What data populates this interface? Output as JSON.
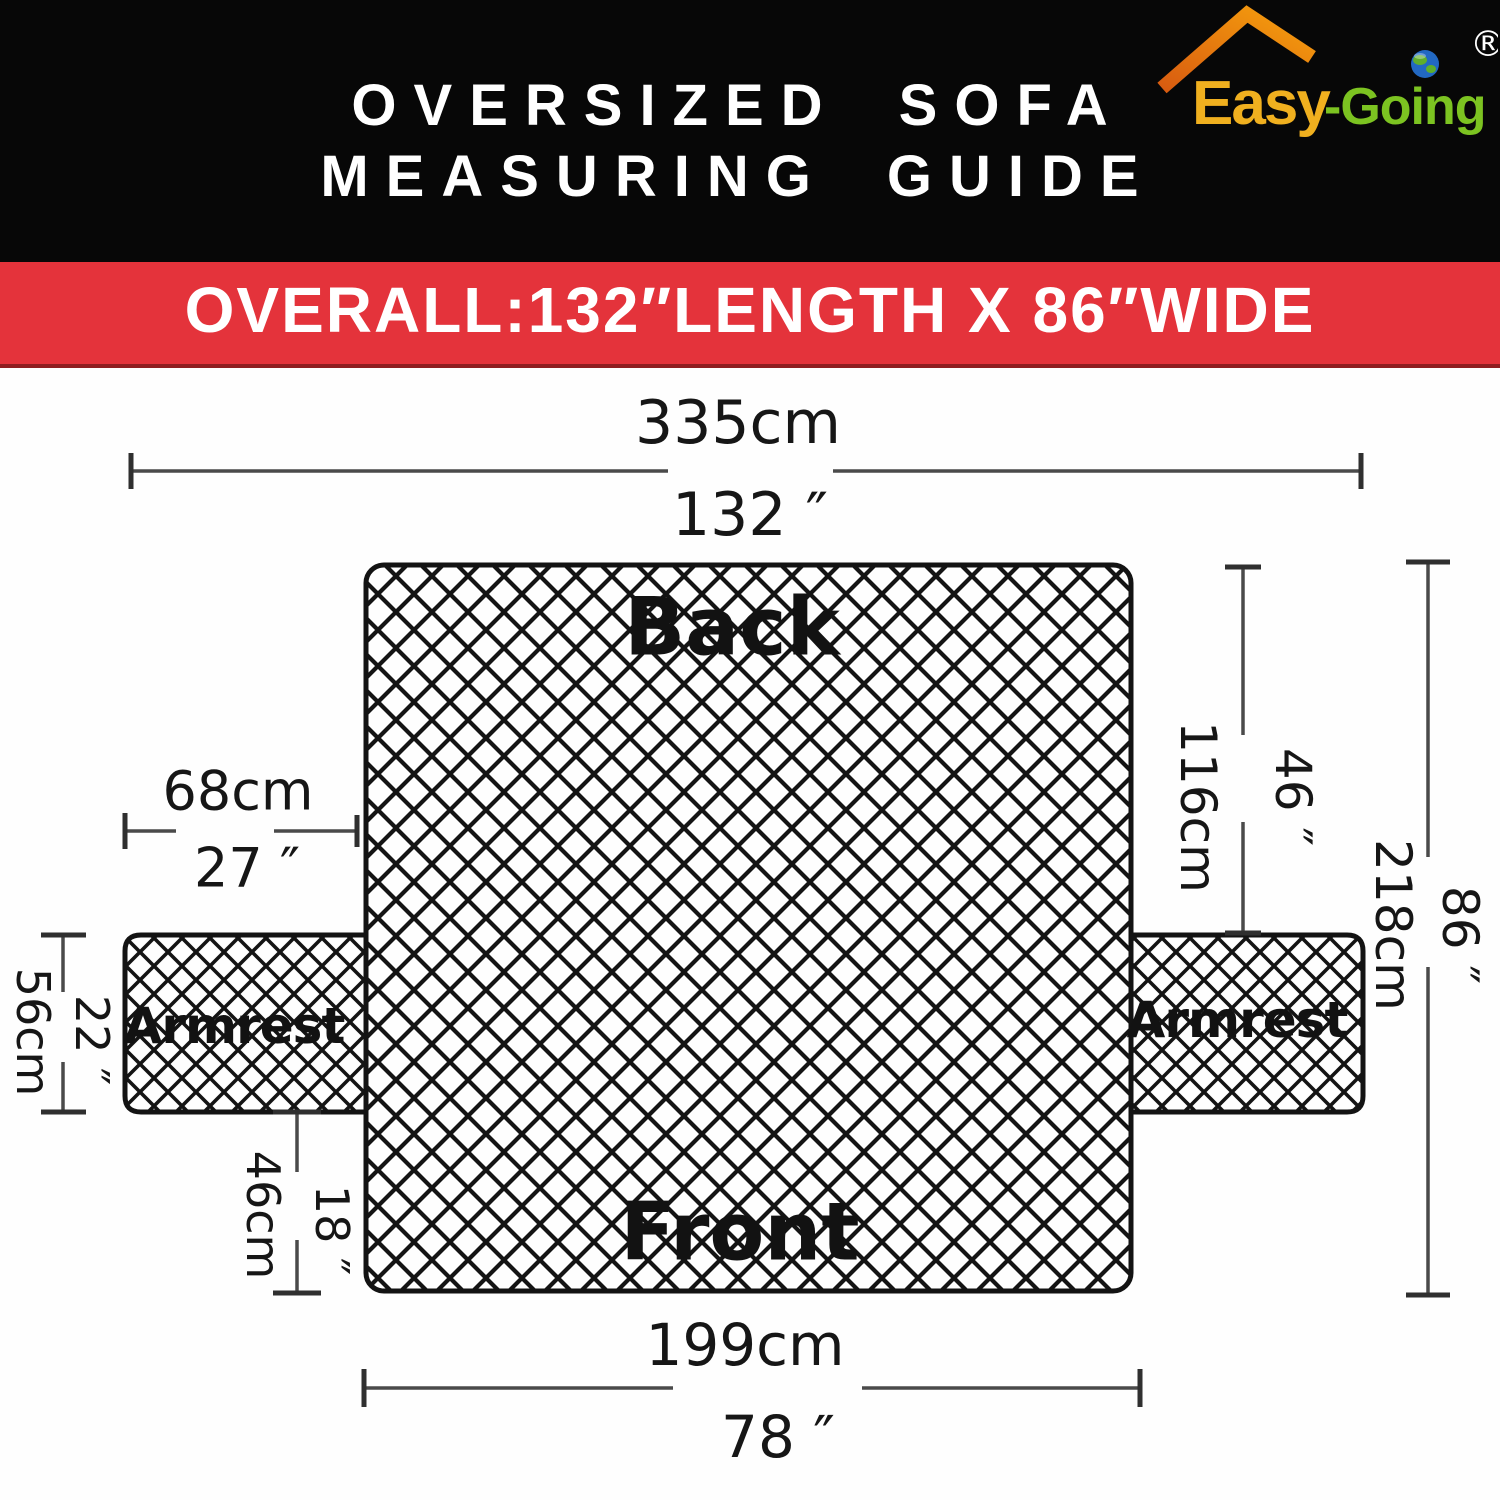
{
  "header": {
    "title_line1": "OVERSIZED SOFA",
    "title_line2": "MEASURING GUIDE",
    "bg_color": "#070707"
  },
  "logo": {
    "brand_first": "Easy",
    "brand_rest": "-Going",
    "registered_mark": "®",
    "colors": {
      "roof_dark": "#d85c10",
      "roof_light": "#f6a00d",
      "easy_gold": "#f0b01f",
      "going_green": "#7cc321",
      "globe_blue": "#2268c2",
      "globe_land": "#5fae2b"
    }
  },
  "banner": {
    "text": "OVERALL:132″LENGTH X 86″WIDE",
    "bg_color": "#e4333b",
    "text_color": "#ffffff"
  },
  "diagram": {
    "section_labels": {
      "back": "Back",
      "front": "Front",
      "armrest_left": "Armrest",
      "armrest_right": "Armrest"
    },
    "dimensions": {
      "overall_length": {
        "cm": "335cm",
        "inch": "132 ″"
      },
      "armrest_length": {
        "cm": "68cm",
        "inch": "27 ″"
      },
      "back_height": {
        "cm": "116cm",
        "inch": "46 ″"
      },
      "overall_width": {
        "cm": "218cm",
        "inch": "86 ″"
      },
      "armrest_width": {
        "cm": "56cm",
        "inch": "22 ″"
      },
      "front_height": {
        "cm": "46cm",
        "inch": "18 ″"
      },
      "front_length": {
        "cm": "199cm",
        "inch": "78 ″"
      }
    }
  }
}
